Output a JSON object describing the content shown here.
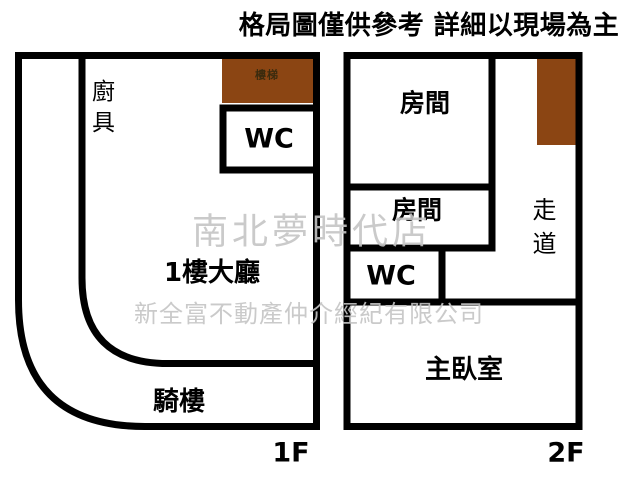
{
  "header": {
    "disclaimer": "格局圖僅供參考 詳細以現場為主"
  },
  "watermark": {
    "store": "南北夢時代店",
    "company": "新全富不動產仲介經紀有限公司"
  },
  "colors": {
    "wall": "#000000",
    "stairs_fill": "#8B4513",
    "stairs_text": "#3b2b0e",
    "watermark_text": "#c5c5c5"
  },
  "floor1": {
    "floor_label": "1F",
    "rooms": {
      "kitchen": "廚具",
      "stairs": "樓梯",
      "wc": "WC",
      "hall": "1樓大廳",
      "arcade": "騎樓"
    }
  },
  "floor2": {
    "floor_label": "2F",
    "rooms": {
      "room1": "房間",
      "room2": "房間",
      "corridor": "走道",
      "wc": "WC",
      "master_bedroom": "主臥室"
    }
  }
}
